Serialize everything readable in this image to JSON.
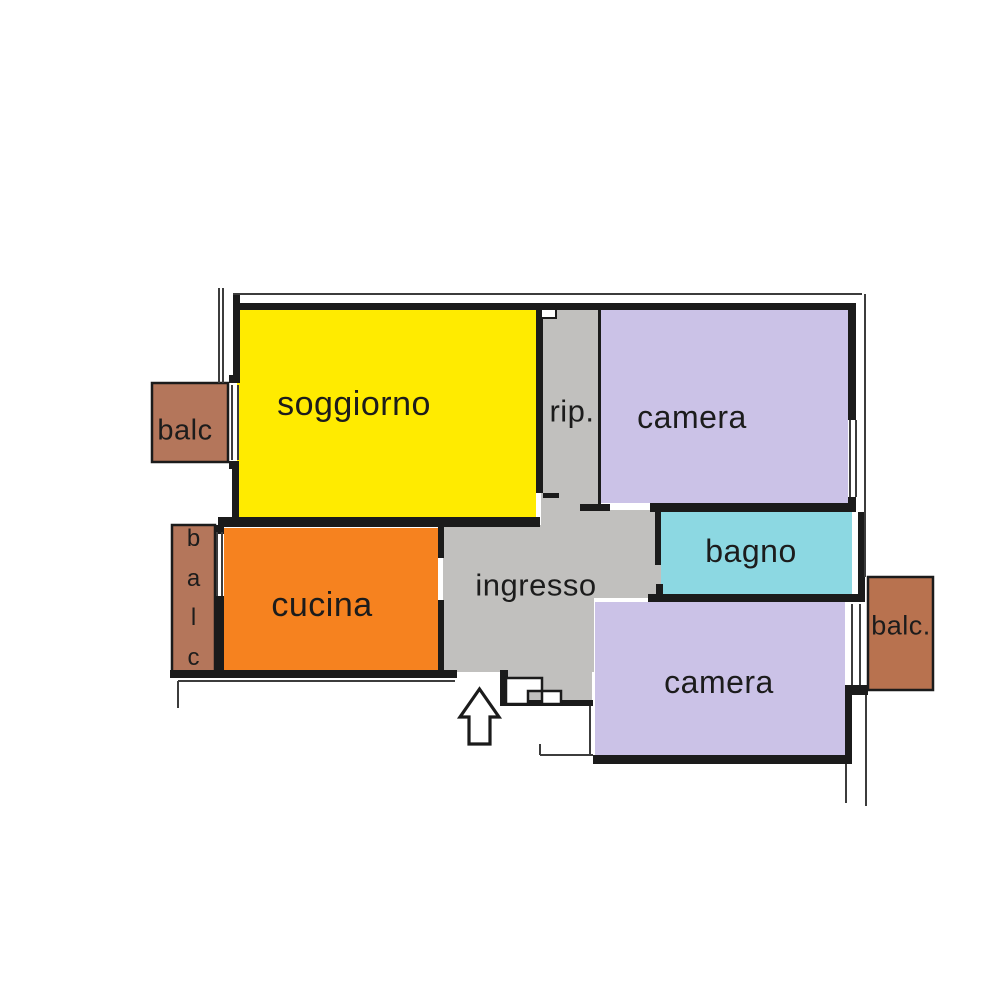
{
  "plan": {
    "type": "apartment-floor-plan",
    "rooms": {
      "soggiorno": {
        "label": "soggiorno",
        "color": "#FFEB00"
      },
      "rip": {
        "label": "rip.",
        "color": "#C1C0BE"
      },
      "camera_top": {
        "label": "camera",
        "color": "#CBC2E7"
      },
      "cucina": {
        "label": "cucina",
        "color": "#F6821F"
      },
      "ingresso": {
        "label": "ingresso",
        "color": "#C1C0BE"
      },
      "bagno": {
        "label": "bagno",
        "color": "#8CD8E2"
      },
      "camera_bottom": {
        "label": "camera",
        "color": "#CBC2E7"
      },
      "balcony_top_left": {
        "label": "balc",
        "color": "#B4765B"
      },
      "balcony_left": {
        "letters": [
          "b",
          "a",
          "l",
          "c"
        ],
        "color": "#B4765B"
      },
      "balcony_right": {
        "label": "balc.",
        "color": "#B8724F"
      }
    },
    "colors": {
      "background": "#FFFFFF",
      "wall": "#1B1B1B",
      "thin_line": "#3C3C3C",
      "text": "#1C1C1C",
      "arrow_fill": "#FFFFFF"
    },
    "entrance_arrow_direction": "up"
  }
}
